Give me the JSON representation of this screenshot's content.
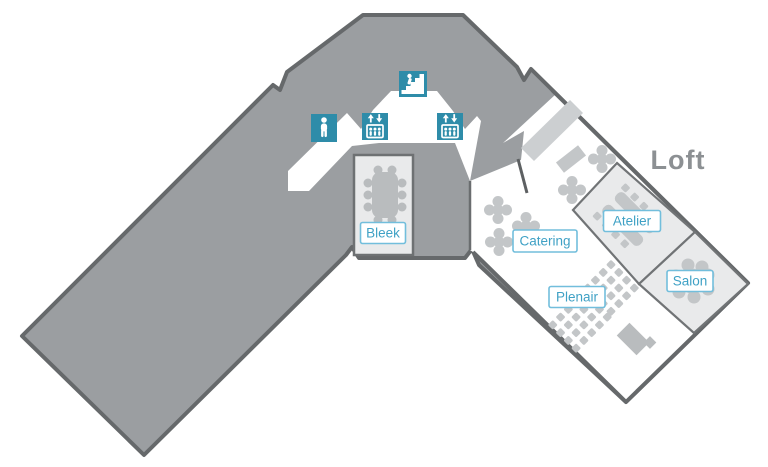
{
  "map": {
    "floor_label": "Loft",
    "rooms": [
      {
        "name": "bleek",
        "label": "Bleek"
      },
      {
        "name": "catering",
        "label": "Catering"
      },
      {
        "name": "plenair",
        "label": "Plenair"
      },
      {
        "name": "atelier",
        "label": "Atelier"
      },
      {
        "name": "salon",
        "label": "Salon"
      }
    ],
    "markers": [
      {
        "name": "toilet-icon"
      },
      {
        "name": "elevator-icon"
      },
      {
        "name": "elevator-icon"
      },
      {
        "name": "stairs-icon"
      }
    ],
    "colors": {
      "building_fill": "#9B9EA1",
      "building_outline": "#66696B",
      "wing_fill": "#FFFFFF",
      "room_fill": "#E9EAEB",
      "room_outline": "#6E7173",
      "furniture": "#C3C6C8",
      "furniture_dark": "#B9BCBE",
      "ramp_fill": "#CCCFD1",
      "marker_teal": "#2E8CA9",
      "label_text": "#3FA1C5",
      "label_border": "#72BEDC",
      "floor_label_text": "#8C9093"
    }
  }
}
